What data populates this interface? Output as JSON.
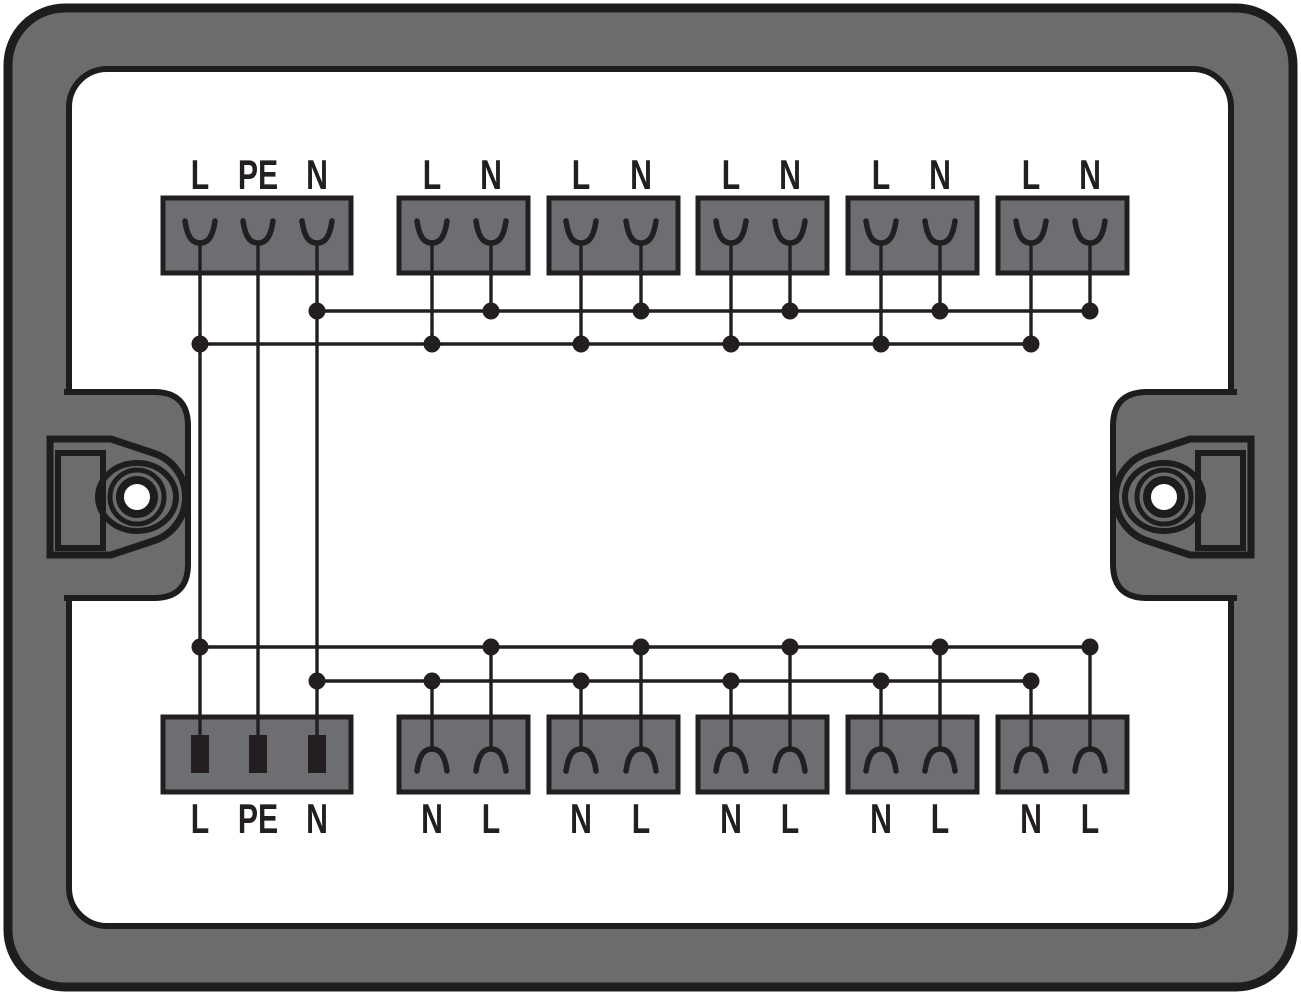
{
  "diagram": {
    "kind": "distribution-box-internal-wiring",
    "description_labels": {
      "line": "L",
      "protective_earth": "PE",
      "neutral": "N"
    }
  },
  "colors": {
    "housing": "#6a6c6e",
    "terminal_block": "#6c6e71",
    "line": "#231f20",
    "panel": "#ffffff"
  },
  "top_row": {
    "blocks": [
      {
        "labels": [
          "L",
          "PE",
          "N"
        ]
      },
      {
        "labels": [
          "L",
          "N"
        ]
      },
      {
        "labels": [
          "L",
          "N"
        ]
      },
      {
        "labels": [
          "L",
          "N"
        ]
      },
      {
        "labels": [
          "L",
          "N"
        ]
      },
      {
        "labels": [
          "L",
          "N"
        ]
      }
    ]
  },
  "bottom_row": {
    "blocks": [
      {
        "labels": [
          "L",
          "PE",
          "N"
        ]
      },
      {
        "labels": [
          "N",
          "L"
        ]
      },
      {
        "labels": [
          "N",
          "L"
        ]
      },
      {
        "labels": [
          "N",
          "L"
        ]
      },
      {
        "labels": [
          "N",
          "L"
        ]
      },
      {
        "labels": [
          "N",
          "L"
        ]
      }
    ]
  }
}
